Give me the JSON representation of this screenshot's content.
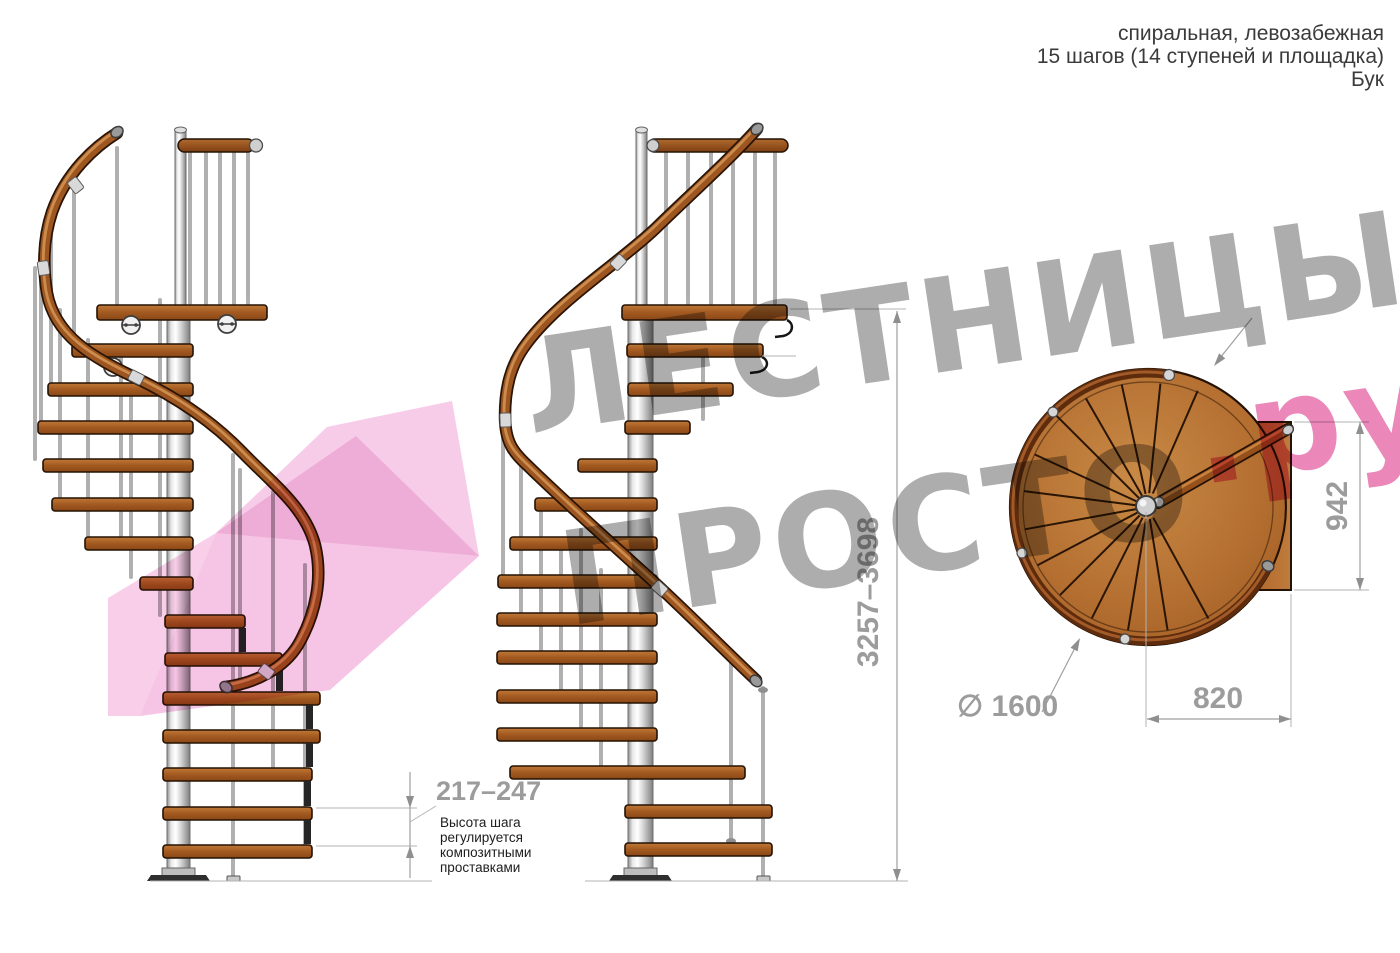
{
  "header": {
    "line1": "спиральная, левозабежная",
    "line2": "15 шагов (14 ступеней и площадка)",
    "line3": "Бук"
  },
  "dimensions": {
    "total_height_range": "3257–3698",
    "step_height_range": "217–247",
    "landing_depth": "942",
    "landing_width": "820",
    "diameter": "∅ 1600"
  },
  "annotation": {
    "lines": [
      "Высота шага",
      "регулируется",
      "композитными",
      "проставками"
    ]
  },
  "watermark": {
    "line1": "ЛЕСТНИЦЫ",
    "line2": "ПРОСТО",
    "line2_suffix": ".ру"
  },
  "colors": {
    "wood": "#a55c22",
    "handrail": "#9d5620",
    "metal": "#d9d9d9",
    "dimension_gray": "#9c9c9c",
    "watermark_gray": "#8a8a8a",
    "watermark_pink": "#df4190",
    "annotation_text": "#1d1d1d"
  }
}
